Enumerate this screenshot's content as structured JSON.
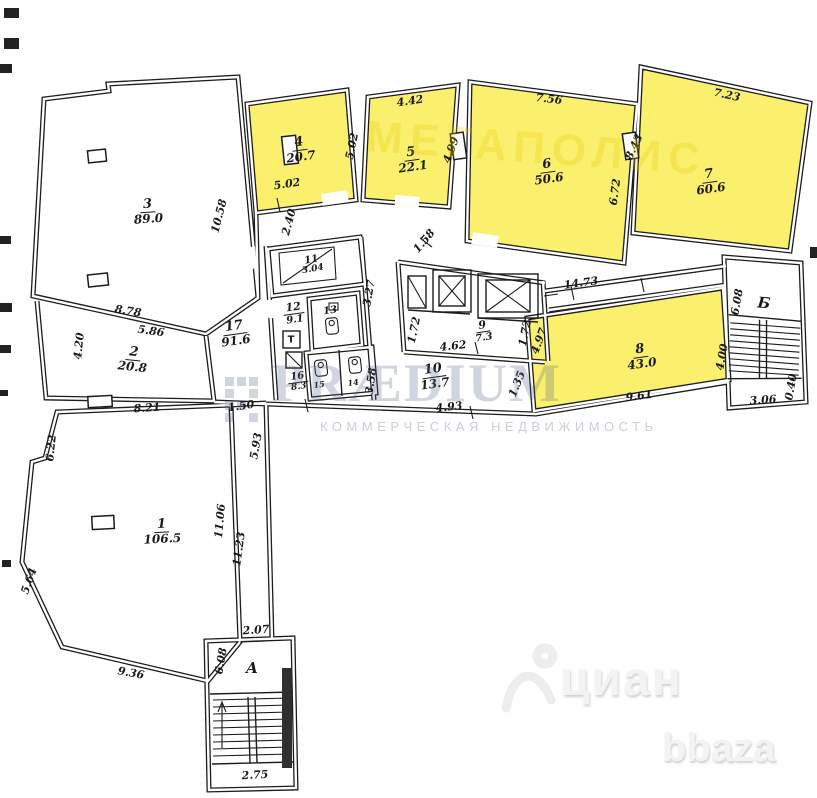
{
  "rooms": {
    "r1": {
      "num": "1",
      "area": "106.5"
    },
    "r2": {
      "num": "2",
      "area": "20.8"
    },
    "r3": {
      "num": "3",
      "area": "89.0"
    },
    "r4": {
      "num": "4",
      "area": "20.7"
    },
    "r5": {
      "num": "5",
      "area": "22.1"
    },
    "r6": {
      "num": "6",
      "area": "50.6"
    },
    "r7": {
      "num": "7",
      "area": "60.6"
    },
    "r8": {
      "num": "8",
      "area": "43.0"
    },
    "r9": {
      "num": "9",
      "area": "7.3"
    },
    "r10": {
      "num": "10",
      "area": "13.7"
    },
    "r11": {
      "num": "11",
      "area": "3.04"
    },
    "r12": {
      "num": "12",
      "area": "9.1"
    },
    "r13": {
      "num": "13"
    },
    "r14": {
      "num": "14"
    },
    "r15": {
      "num": "15"
    },
    "r16": {
      "num": "16",
      "area": "8.3"
    },
    "r17": {
      "num": "17",
      "area": "91.6"
    },
    "stair_a": "А",
    "stair_b": "Б",
    "shaft_t": "Т"
  },
  "dimensions": {
    "room5_top": "4.42",
    "room6_top": "7.56",
    "room7_top": "7.23",
    "div45_left": "5.02",
    "room4_bottom": "5.02",
    "div56": "4.99",
    "room7_left": "8.43",
    "room6_right": "6.72",
    "room3_right_diag": "10.58",
    "below_room4": "2.40",
    "core_top_diag": "1.58",
    "room3_bottom_a": "8.78",
    "room3_bottom_b": "5.86",
    "room2_left": "4.20",
    "corridor_to_stair_b": "14.73",
    "stair_b_left": "6.08",
    "stair_b_bottom": "3.06",
    "stair_b_right": "0.40",
    "room8_right": "4.00",
    "room8_bottom": "9.61",
    "room8_left_diag": "4.97",
    "core_left": "1.72",
    "core_right": "1.72",
    "room9_bottom": "4.62",
    "room8_corner": "1.35",
    "block_right_upper": "3.27",
    "block_right_lower": "3.58",
    "room10_bottom": "4.93",
    "room1_top": "8.21",
    "room1_top_right": "1.50",
    "corridor_right": "5.93",
    "room1_left": "6.22",
    "room1_left_diag": "5.64",
    "room1_bottom": "9.36",
    "corridor_a_left": "11.06",
    "corridor_a_right": "11.23",
    "stair_a_top": "2.07",
    "stair_a_left": "6.08",
    "stair_a_bottom": "2.75"
  },
  "watermarks": {
    "ghost_top": "МЕГАПОЛИС",
    "brand": "PRÆDIUM",
    "brand_sub": "КОММЕРЧЕСКАЯ НЕДВИЖИМОСТЬ",
    "cian": "циан",
    "bbaza": "bbaza"
  },
  "colors": {
    "room_highlight": "#faf06e",
    "wall": "#1c1c1c",
    "brand_watermark": "#4a5e86"
  }
}
